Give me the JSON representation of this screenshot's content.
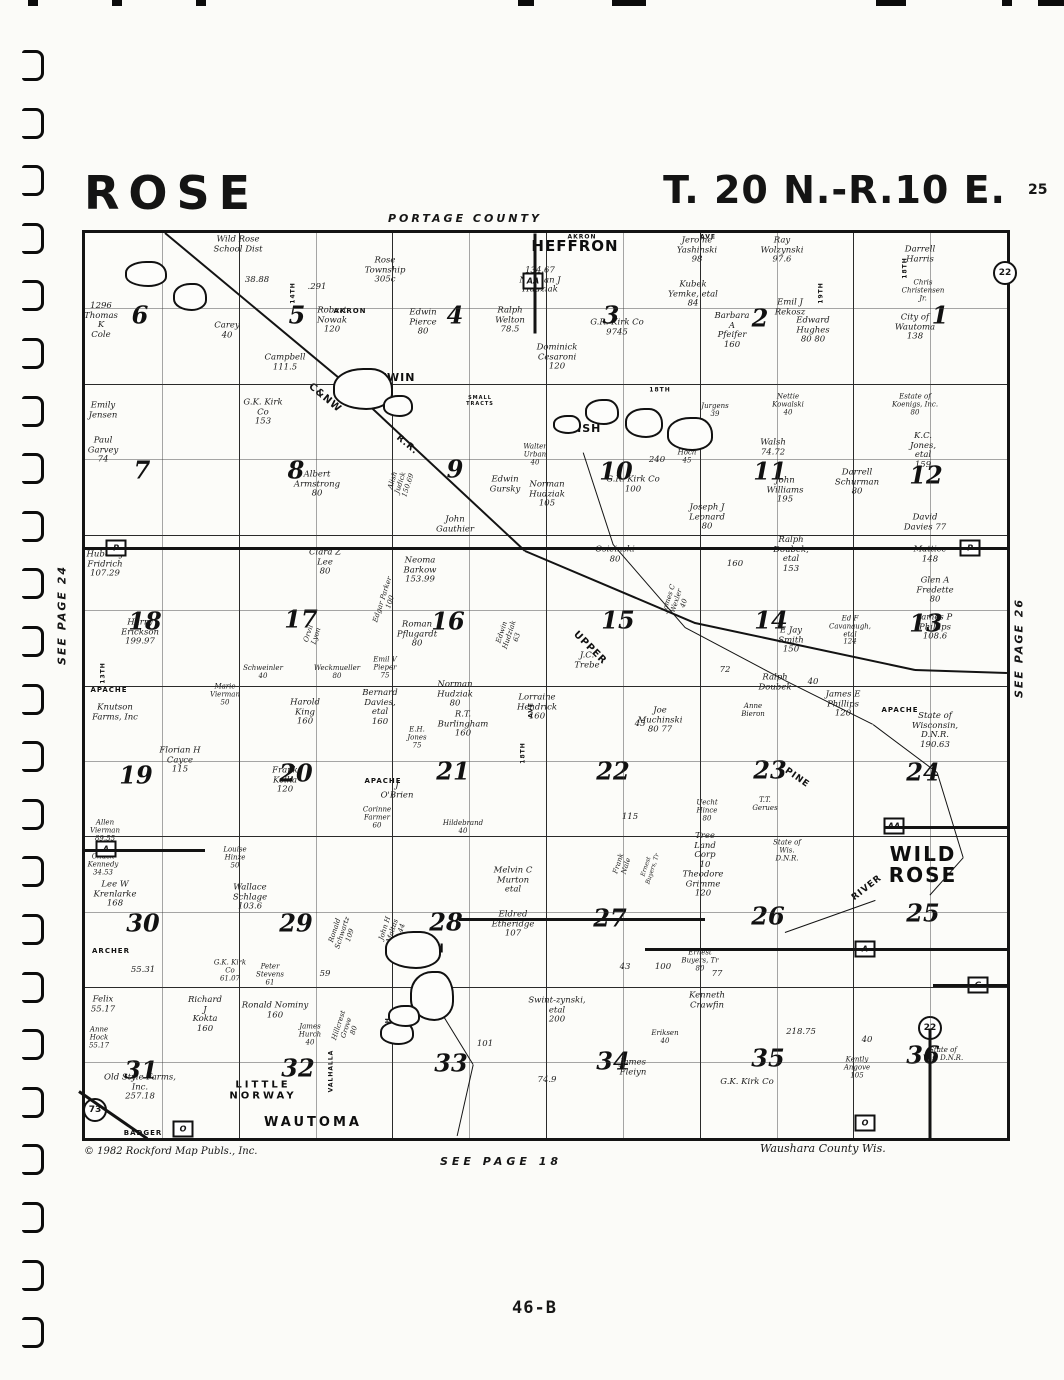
{
  "page": {
    "title_left": "ROSE",
    "title_right": "T. 20 N.-R.10 E.",
    "corner_number": "25",
    "portage_county": "PORTAGE COUNTY",
    "see_page_24": "SEE PAGE 24",
    "see_page_26": "SEE PAGE 26",
    "see_page_18": "SEE PAGE 18",
    "waushara": "Waushara County Wis.",
    "copyright": "© 1982 Rockford Map Publs., Inc.",
    "page_label": "46-B"
  },
  "map": {
    "towns": [
      {
        "t": "HEFFRON",
        "x": 490,
        "y": 14,
        "fs": 15,
        "ls": 1
      },
      {
        "t": "WILD\nROSE",
        "x": 838,
        "y": 632,
        "fs": 20,
        "ls": 2
      },
      {
        "t": "WAUTOMA",
        "x": 228,
        "y": 890,
        "fs": 13,
        "ls": 3
      },
      {
        "t": "LITTLE\nNORWAY",
        "x": 178,
        "y": 858,
        "fs": 10,
        "ls": 3
      },
      {
        "t": "CHAIN",
        "x": 336,
        "y": 716,
        "fs": 12,
        "ls": 1
      },
      {
        "t": "FISH",
        "x": 500,
        "y": 196,
        "fs": 11,
        "ls": 1
      },
      {
        "t": "TWIN",
        "x": 312,
        "y": 145,
        "fs": 11,
        "ls": 1
      }
    ],
    "sections": [
      {
        "n": "6",
        "x": 55,
        "y": 82
      },
      {
        "n": "5",
        "x": 212,
        "y": 82
      },
      {
        "n": "4",
        "x": 370,
        "y": 82
      },
      {
        "n": "3",
        "x": 526,
        "y": 82
      },
      {
        "n": "2",
        "x": 675,
        "y": 85
      },
      {
        "n": "1",
        "x": 855,
        "y": 82
      },
      {
        "n": "7",
        "x": 57,
        "y": 237
      },
      {
        "n": "8",
        "x": 211,
        "y": 237
      },
      {
        "n": "9",
        "x": 370,
        "y": 236
      },
      {
        "n": "10",
        "x": 531,
        "y": 238
      },
      {
        "n": "11",
        "x": 685,
        "y": 238
      },
      {
        "n": "12",
        "x": 841,
        "y": 242
      },
      {
        "n": "18",
        "x": 60,
        "y": 388
      },
      {
        "n": "17",
        "x": 216,
        "y": 386
      },
      {
        "n": "16",
        "x": 363,
        "y": 388
      },
      {
        "n": "15",
        "x": 533,
        "y": 387
      },
      {
        "n": "14",
        "x": 686,
        "y": 387
      },
      {
        "n": "13",
        "x": 841,
        "y": 390
      },
      {
        "n": "19",
        "x": 51,
        "y": 542
      },
      {
        "n": "20",
        "x": 211,
        "y": 540
      },
      {
        "n": "21",
        "x": 368,
        "y": 538
      },
      {
        "n": "22",
        "x": 528,
        "y": 538
      },
      {
        "n": "23",
        "x": 685,
        "y": 537
      },
      {
        "n": "24",
        "x": 838,
        "y": 539
      },
      {
        "n": "30",
        "x": 58,
        "y": 690
      },
      {
        "n": "29",
        "x": 211,
        "y": 690
      },
      {
        "n": "28",
        "x": 361,
        "y": 689
      },
      {
        "n": "27",
        "x": 525,
        "y": 685
      },
      {
        "n": "26",
        "x": 683,
        "y": 683
      },
      {
        "n": "25",
        "x": 838,
        "y": 680
      },
      {
        "n": "31",
        "x": 56,
        "y": 837
      },
      {
        "n": "32",
        "x": 213,
        "y": 835
      },
      {
        "n": "33",
        "x": 366,
        "y": 830
      },
      {
        "n": "34",
        "x": 528,
        "y": 828
      },
      {
        "n": "35",
        "x": 683,
        "y": 825
      },
      {
        "n": "36",
        "x": 838,
        "y": 822
      }
    ],
    "markers": [
      {
        "t": "P",
        "s": "sq",
        "x": 31,
        "y": 315
      },
      {
        "t": "P",
        "s": "sq",
        "x": 885,
        "y": 315
      },
      {
        "t": "AA",
        "s": "sq",
        "x": 448,
        "y": 48
      },
      {
        "t": "AA",
        "s": "sq",
        "x": 809,
        "y": 593
      },
      {
        "t": "A",
        "s": "sq",
        "x": 21,
        "y": 616
      },
      {
        "t": "A",
        "s": "sq",
        "x": 780,
        "y": 716
      },
      {
        "t": "O",
        "s": "sq",
        "x": 98,
        "y": 896
      },
      {
        "t": "O",
        "s": "sq",
        "x": 780,
        "y": 890
      },
      {
        "t": "G",
        "s": "sq",
        "x": 893,
        "y": 752
      },
      {
        "t": "22",
        "s": "ci",
        "x": 920,
        "y": 40
      },
      {
        "t": "22",
        "s": "ci",
        "x": 845,
        "y": 795
      },
      {
        "t": "73",
        "s": "ci",
        "x": 10,
        "y": 877
      }
    ],
    "road_labels": [
      {
        "t": "AKRON",
        "x": 265,
        "y": 78
      },
      {
        "t": "AKRON",
        "x": 497,
        "y": 4,
        "fs": 6
      },
      {
        "t": "AVE",
        "x": 623,
        "y": 4,
        "fs": 6
      },
      {
        "t": "18TH",
        "x": 820,
        "y": 35,
        "r": -90,
        "fs": 6
      },
      {
        "t": "14TH",
        "x": 208,
        "y": 60,
        "r": -90,
        "fs": 6
      },
      {
        "t": "18TH",
        "x": 575,
        "y": 157,
        "fs": 6
      },
      {
        "t": "13TH",
        "x": 18,
        "y": 440,
        "r": -90,
        "fs": 6
      },
      {
        "t": "APACHE",
        "x": 24,
        "y": 457
      },
      {
        "t": "APACHE",
        "x": 298,
        "y": 548
      },
      {
        "t": "APACHE",
        "x": 815,
        "y": 477
      },
      {
        "t": "AVE",
        "x": 446,
        "y": 477,
        "r": -90,
        "fs": 6
      },
      {
        "t": "18TH",
        "x": 438,
        "y": 520,
        "r": -90,
        "fs": 6
      },
      {
        "t": "ARCHER",
        "x": 26,
        "y": 718
      },
      {
        "t": "14TH",
        "x": 303,
        "y": 795,
        "r": -90,
        "fs": 6
      },
      {
        "t": "VALHALLA",
        "x": 246,
        "y": 838,
        "r": -90,
        "fs": 6
      },
      {
        "t": "BADGER",
        "x": 58,
        "y": 900
      },
      {
        "t": "19TH",
        "x": 736,
        "y": 60,
        "r": -90,
        "fs": 6
      },
      {
        "t": "SMALL\nTRACTS",
        "x": 395,
        "y": 168,
        "fs": 5
      },
      {
        "t": "C&NW",
        "x": 240,
        "y": 165,
        "r": 40,
        "fs": 10
      },
      {
        "t": "R.R.",
        "x": 322,
        "y": 212,
        "r": 40,
        "fs": 9
      },
      {
        "t": "UPPER",
        "x": 505,
        "y": 415,
        "r": 45,
        "fs": 10
      },
      {
        "t": "PINE",
        "x": 712,
        "y": 545,
        "r": 35,
        "fs": 9
      },
      {
        "t": "RIVER",
        "x": 782,
        "y": 655,
        "r": -38,
        "fs": 9
      }
    ],
    "parcels": [
      {
        "t": "Wild Rose\nSchool Dist",
        "x": 153,
        "y": 12
      },
      {
        "t": "38.88",
        "x": 172,
        "y": 48
      },
      {
        "t": ".291",
        "x": 232,
        "y": 55
      },
      {
        "t": "Rose\nTownship\n305c",
        "x": 300,
        "y": 38
      },
      {
        "t": "134.67\nNorman J\nHudziak",
        "x": 455,
        "y": 48
      },
      {
        "t": "Jerome\nYashinski\n98",
        "x": 612,
        "y": 18
      },
      {
        "t": "Ray\nWolzynski\n97.6",
        "x": 697,
        "y": 18
      },
      {
        "t": "Kubek\nYemke, etal\n84",
        "x": 608,
        "y": 62
      },
      {
        "t": "Emil J\nRekosz",
        "x": 705,
        "y": 75
      },
      {
        "t": "Darrell\nHarris",
        "x": 835,
        "y": 22
      },
      {
        "t": "Chris\nChristensen\nJr.",
        "x": 838,
        "y": 58,
        "fs": 7
      },
      {
        "t": "1296\nThomas\nK\nCole",
        "x": 16,
        "y": 88
      },
      {
        "t": "Carey\n40",
        "x": 142,
        "y": 98
      },
      {
        "t": "Robert\nNowak\n120",
        "x": 247,
        "y": 88
      },
      {
        "t": "Edwin\nPierce\n80",
        "x": 338,
        "y": 90
      },
      {
        "t": "Ralph\nWelton\n78.5",
        "x": 425,
        "y": 88
      },
      {
        "t": "G.R. Kirk Co\n9745",
        "x": 532,
        "y": 95
      },
      {
        "t": "Barbara\nA\nPfeifer\n160",
        "x": 647,
        "y": 98
      },
      {
        "t": "Edward\nHughes\n80   80",
        "x": 728,
        "y": 98
      },
      {
        "t": "City of\nWautoma\n138",
        "x": 830,
        "y": 95
      },
      {
        "t": "Campbell\n111.5",
        "x": 200,
        "y": 130
      },
      {
        "t": "Dominick\nCesaroni\n120",
        "x": 472,
        "y": 125
      },
      {
        "t": "Emily\nJensen",
        "x": 18,
        "y": 178
      },
      {
        "t": "Paul\nGarvey\n74",
        "x": 18,
        "y": 218
      },
      {
        "t": "G.K. Kirk\nCo\n153",
        "x": 178,
        "y": 180
      },
      {
        "t": "Albert\nArmstrong\n80",
        "x": 232,
        "y": 252
      },
      {
        "t": "Alish\nJudick\n150.69",
        "x": 316,
        "y": 250,
        "r": -72,
        "fs": 7
      },
      {
        "t": "Walter\nUrban\n40",
        "x": 450,
        "y": 222,
        "fs": 7
      },
      {
        "t": "Edwin\nGursky",
        "x": 420,
        "y": 252
      },
      {
        "t": "Norman\nHudziak\n105",
        "x": 462,
        "y": 262
      },
      {
        "t": "G.R. Kirk Co\n100",
        "x": 548,
        "y": 252
      },
      {
        "t": "240",
        "x": 572,
        "y": 228
      },
      {
        "t": "Rich\nHoch\n45",
        "x": 602,
        "y": 220,
        "fs": 7
      },
      {
        "t": "Jurgens\n39",
        "x": 630,
        "y": 178,
        "fs": 7
      },
      {
        "t": "Nettie\nKowalski\n40",
        "x": 703,
        "y": 172,
        "fs": 7
      },
      {
        "t": "Estate of\nKoenigs, Inc.\n80",
        "x": 830,
        "y": 172,
        "fs": 7
      },
      {
        "t": "Walsh\n74.72",
        "x": 688,
        "y": 215
      },
      {
        "t": "K.C.\nJones,\netal\n159",
        "x": 838,
        "y": 218
      },
      {
        "t": "John\nWilliams\n195",
        "x": 700,
        "y": 258
      },
      {
        "t": "Darrell\nSchurman\n80",
        "x": 772,
        "y": 250
      },
      {
        "t": "Joseph J\nLeonard\n80",
        "x": 622,
        "y": 285
      },
      {
        "t": "David\nDavies 77",
        "x": 840,
        "y": 290
      },
      {
        "t": "John\nGauthier",
        "x": 370,
        "y": 292
      },
      {
        "t": "Hubert J\nFridrich\n107.29",
        "x": 20,
        "y": 332
      },
      {
        "t": "Clara Z\nLee\n80",
        "x": 240,
        "y": 330
      },
      {
        "t": "Edgar Parker\n100",
        "x": 302,
        "y": 368,
        "r": -72,
        "fs": 7
      },
      {
        "t": "Neoma\nBarkow\n153.99",
        "x": 335,
        "y": 338
      },
      {
        "t": "Osieinski\n80",
        "x": 530,
        "y": 322
      },
      {
        "t": "160",
        "x": 650,
        "y": 332
      },
      {
        "t": "Ralph\nDoubek,\netal\n153",
        "x": 706,
        "y": 322
      },
      {
        "t": "Mattice\n148",
        "x": 845,
        "y": 322
      },
      {
        "t": "Glen A\nFredette\n80",
        "x": 850,
        "y": 358
      },
      {
        "t": "James P\nPhillips\n108.6",
        "x": 850,
        "y": 395
      },
      {
        "t": "Harry\nErickson\n199.97",
        "x": 55,
        "y": 400
      },
      {
        "t": "Orvil\nLyon",
        "x": 228,
        "y": 402,
        "r": -72,
        "fs": 7
      },
      {
        "t": "Roman\nPflugardt\n80",
        "x": 332,
        "y": 402
      },
      {
        "t": "Schweinler\n40",
        "x": 178,
        "y": 440,
        "fs": 7
      },
      {
        "t": "Weckmueller\n80",
        "x": 252,
        "y": 440,
        "fs": 7
      },
      {
        "t": "Emil V\nPieper\n75",
        "x": 300,
        "y": 435,
        "fs": 7
      },
      {
        "t": "Edwin\nHudziak\n63",
        "x": 425,
        "y": 402,
        "r": -72,
        "fs": 7
      },
      {
        "t": "J.C.\nTrebe",
        "x": 502,
        "y": 428
      },
      {
        "t": "James C\nWexler\n40",
        "x": 592,
        "y": 368,
        "r": -72,
        "fs": 7
      },
      {
        "t": "E Jay\nSmith\n150",
        "x": 706,
        "y": 408
      },
      {
        "t": "Ed F\nCavanaugh,\netal\n124",
        "x": 765,
        "y": 398,
        "fs": 7
      },
      {
        "t": "Ralph\nDoubek",
        "x": 690,
        "y": 450
      },
      {
        "t": "72",
        "x": 640,
        "y": 438
      },
      {
        "t": "40",
        "x": 728,
        "y": 450
      },
      {
        "t": "Knutson\nFarms, Inc",
        "x": 30,
        "y": 480
      },
      {
        "t": "Marie\nVierman\n50",
        "x": 140,
        "y": 462,
        "fs": 7
      },
      {
        "t": "Harold\nKing\n160",
        "x": 220,
        "y": 480
      },
      {
        "t": "Bernard\nDavies,\netal\n160",
        "x": 295,
        "y": 475
      },
      {
        "t": "Norman\nHudziak\n80",
        "x": 370,
        "y": 462
      },
      {
        "t": "E.H.\nJones\n75",
        "x": 332,
        "y": 505,
        "fs": 7
      },
      {
        "t": "R.T.\nBurlingham\n160",
        "x": 378,
        "y": 492
      },
      {
        "t": "Lorraine\nHendrick\n160",
        "x": 452,
        "y": 475
      },
      {
        "t": "45",
        "x": 555,
        "y": 492
      },
      {
        "t": "Joe\nMuchinski\n80    77",
        "x": 575,
        "y": 488
      },
      {
        "t": "Anne\nBieron",
        "x": 668,
        "y": 478,
        "fs": 7
      },
      {
        "t": "James E\nPhillips\n120",
        "x": 758,
        "y": 472
      },
      {
        "t": "State of\nWisconsin,\nD.N.R.\n190.63",
        "x": 850,
        "y": 498
      },
      {
        "t": "Florian H\nCayce\n115",
        "x": 95,
        "y": 528
      },
      {
        "t": "Frank\nKelka\n120",
        "x": 200,
        "y": 548
      },
      {
        "t": "J\nO'Brien",
        "x": 312,
        "y": 558
      },
      {
        "t": "Hildebrand\n40",
        "x": 378,
        "y": 595,
        "fs": 7
      },
      {
        "t": "115",
        "x": 545,
        "y": 585
      },
      {
        "t": "Uecht\nHince\n80",
        "x": 622,
        "y": 578,
        "fs": 7
      },
      {
        "t": "T.T.\nGerues",
        "x": 680,
        "y": 572,
        "fs": 7
      },
      {
        "t": "Tree\nLand\nCorp\n10",
        "x": 620,
        "y": 618
      },
      {
        "t": "Theodore\nGrimme\n120",
        "x": 618,
        "y": 652
      },
      {
        "t": "State of\nWis.\nD.N.R.",
        "x": 702,
        "y": 618,
        "fs": 7
      },
      {
        "t": "Allen\nVierman\n89.55",
        "x": 20,
        "y": 598,
        "fs": 7
      },
      {
        "t": "Chuck\nKennedy\n34.53",
        "x": 18,
        "y": 632,
        "fs": 7
      },
      {
        "t": "Louise\nHinze\n50",
        "x": 150,
        "y": 625,
        "fs": 7
      },
      {
        "t": "Lee W\nKrenlarke\n168",
        "x": 30,
        "y": 662
      },
      {
        "t": "Wallace\nSchlage\n103.6",
        "x": 165,
        "y": 665
      },
      {
        "t": "Corinne\nFarmer\n60",
        "x": 292,
        "y": 585,
        "fs": 7
      },
      {
        "t": "Ronald\nSchwartz\n109",
        "x": 258,
        "y": 700,
        "r": -72,
        "fs": 7
      },
      {
        "t": "John H\nMaltas\n91.44",
        "x": 308,
        "y": 698,
        "r": -72,
        "fs": 7
      },
      {
        "t": "Melvin C\nMurton\netal",
        "x": 428,
        "y": 648
      },
      {
        "t": "Eldred\nEtheridge\n107",
        "x": 428,
        "y": 692
      },
      {
        "t": "43",
        "x": 540,
        "y": 735
      },
      {
        "t": "100",
        "x": 578,
        "y": 735
      },
      {
        "t": "Frank\nNale",
        "x": 538,
        "y": 632,
        "r": -72,
        "fs": 7
      },
      {
        "t": "Ernest\nBuyers, Tr",
        "x": 565,
        "y": 635,
        "r": -72,
        "fs": 6
      },
      {
        "t": "Ernest\nBuyers, Tr\n80",
        "x": 615,
        "y": 728,
        "fs": 7
      },
      {
        "t": "Kenneth\nCrawfin",
        "x": 622,
        "y": 768
      },
      {
        "t": "G.K. Kirk\nCo\n61.07",
        "x": 145,
        "y": 738,
        "fs": 7
      },
      {
        "t": "Peter\nStevens\n61",
        "x": 185,
        "y": 742,
        "fs": 7
      },
      {
        "t": "55.31",
        "x": 58,
        "y": 738
      },
      {
        "t": "59",
        "x": 240,
        "y": 742
      },
      {
        "t": "77",
        "x": 632,
        "y": 742
      },
      {
        "t": "Felix\n55.17",
        "x": 18,
        "y": 772
      },
      {
        "t": "Anne\nHock\n55.17",
        "x": 14,
        "y": 805,
        "fs": 7
      },
      {
        "t": "Richard\nJ\nKokta\n160",
        "x": 120,
        "y": 782
      },
      {
        "t": "Ronald Nominy\n160",
        "x": 190,
        "y": 778
      },
      {
        "t": "James\nHurch\n40",
        "x": 225,
        "y": 802,
        "fs": 7
      },
      {
        "t": "Old Style Farms,\nInc.\n257.18",
        "x": 55,
        "y": 855
      },
      {
        "t": "Hillcrest\nGrove\n80",
        "x": 262,
        "y": 795,
        "r": -72,
        "fs": 7
      },
      {
        "t": "Swint-zynski,\netal\n200",
        "x": 472,
        "y": 778
      },
      {
        "t": "101",
        "x": 400,
        "y": 812
      },
      {
        "t": "74.9",
        "x": 462,
        "y": 848
      },
      {
        "t": "James\nFleiyn",
        "x": 548,
        "y": 835
      },
      {
        "t": "Eriksen\n40",
        "x": 580,
        "y": 805,
        "fs": 7
      },
      {
        "t": "218.75",
        "x": 716,
        "y": 800
      },
      {
        "t": "40",
        "x": 782,
        "y": 808
      },
      {
        "t": "G.K. Kirk Co",
        "x": 662,
        "y": 850
      },
      {
        "t": "Kently\nAngove\n105",
        "x": 772,
        "y": 835,
        "fs": 7
      },
      {
        "t": "State of\nWis. D.N.R.",
        "x": 858,
        "y": 822,
        "fs": 7
      }
    ]
  }
}
